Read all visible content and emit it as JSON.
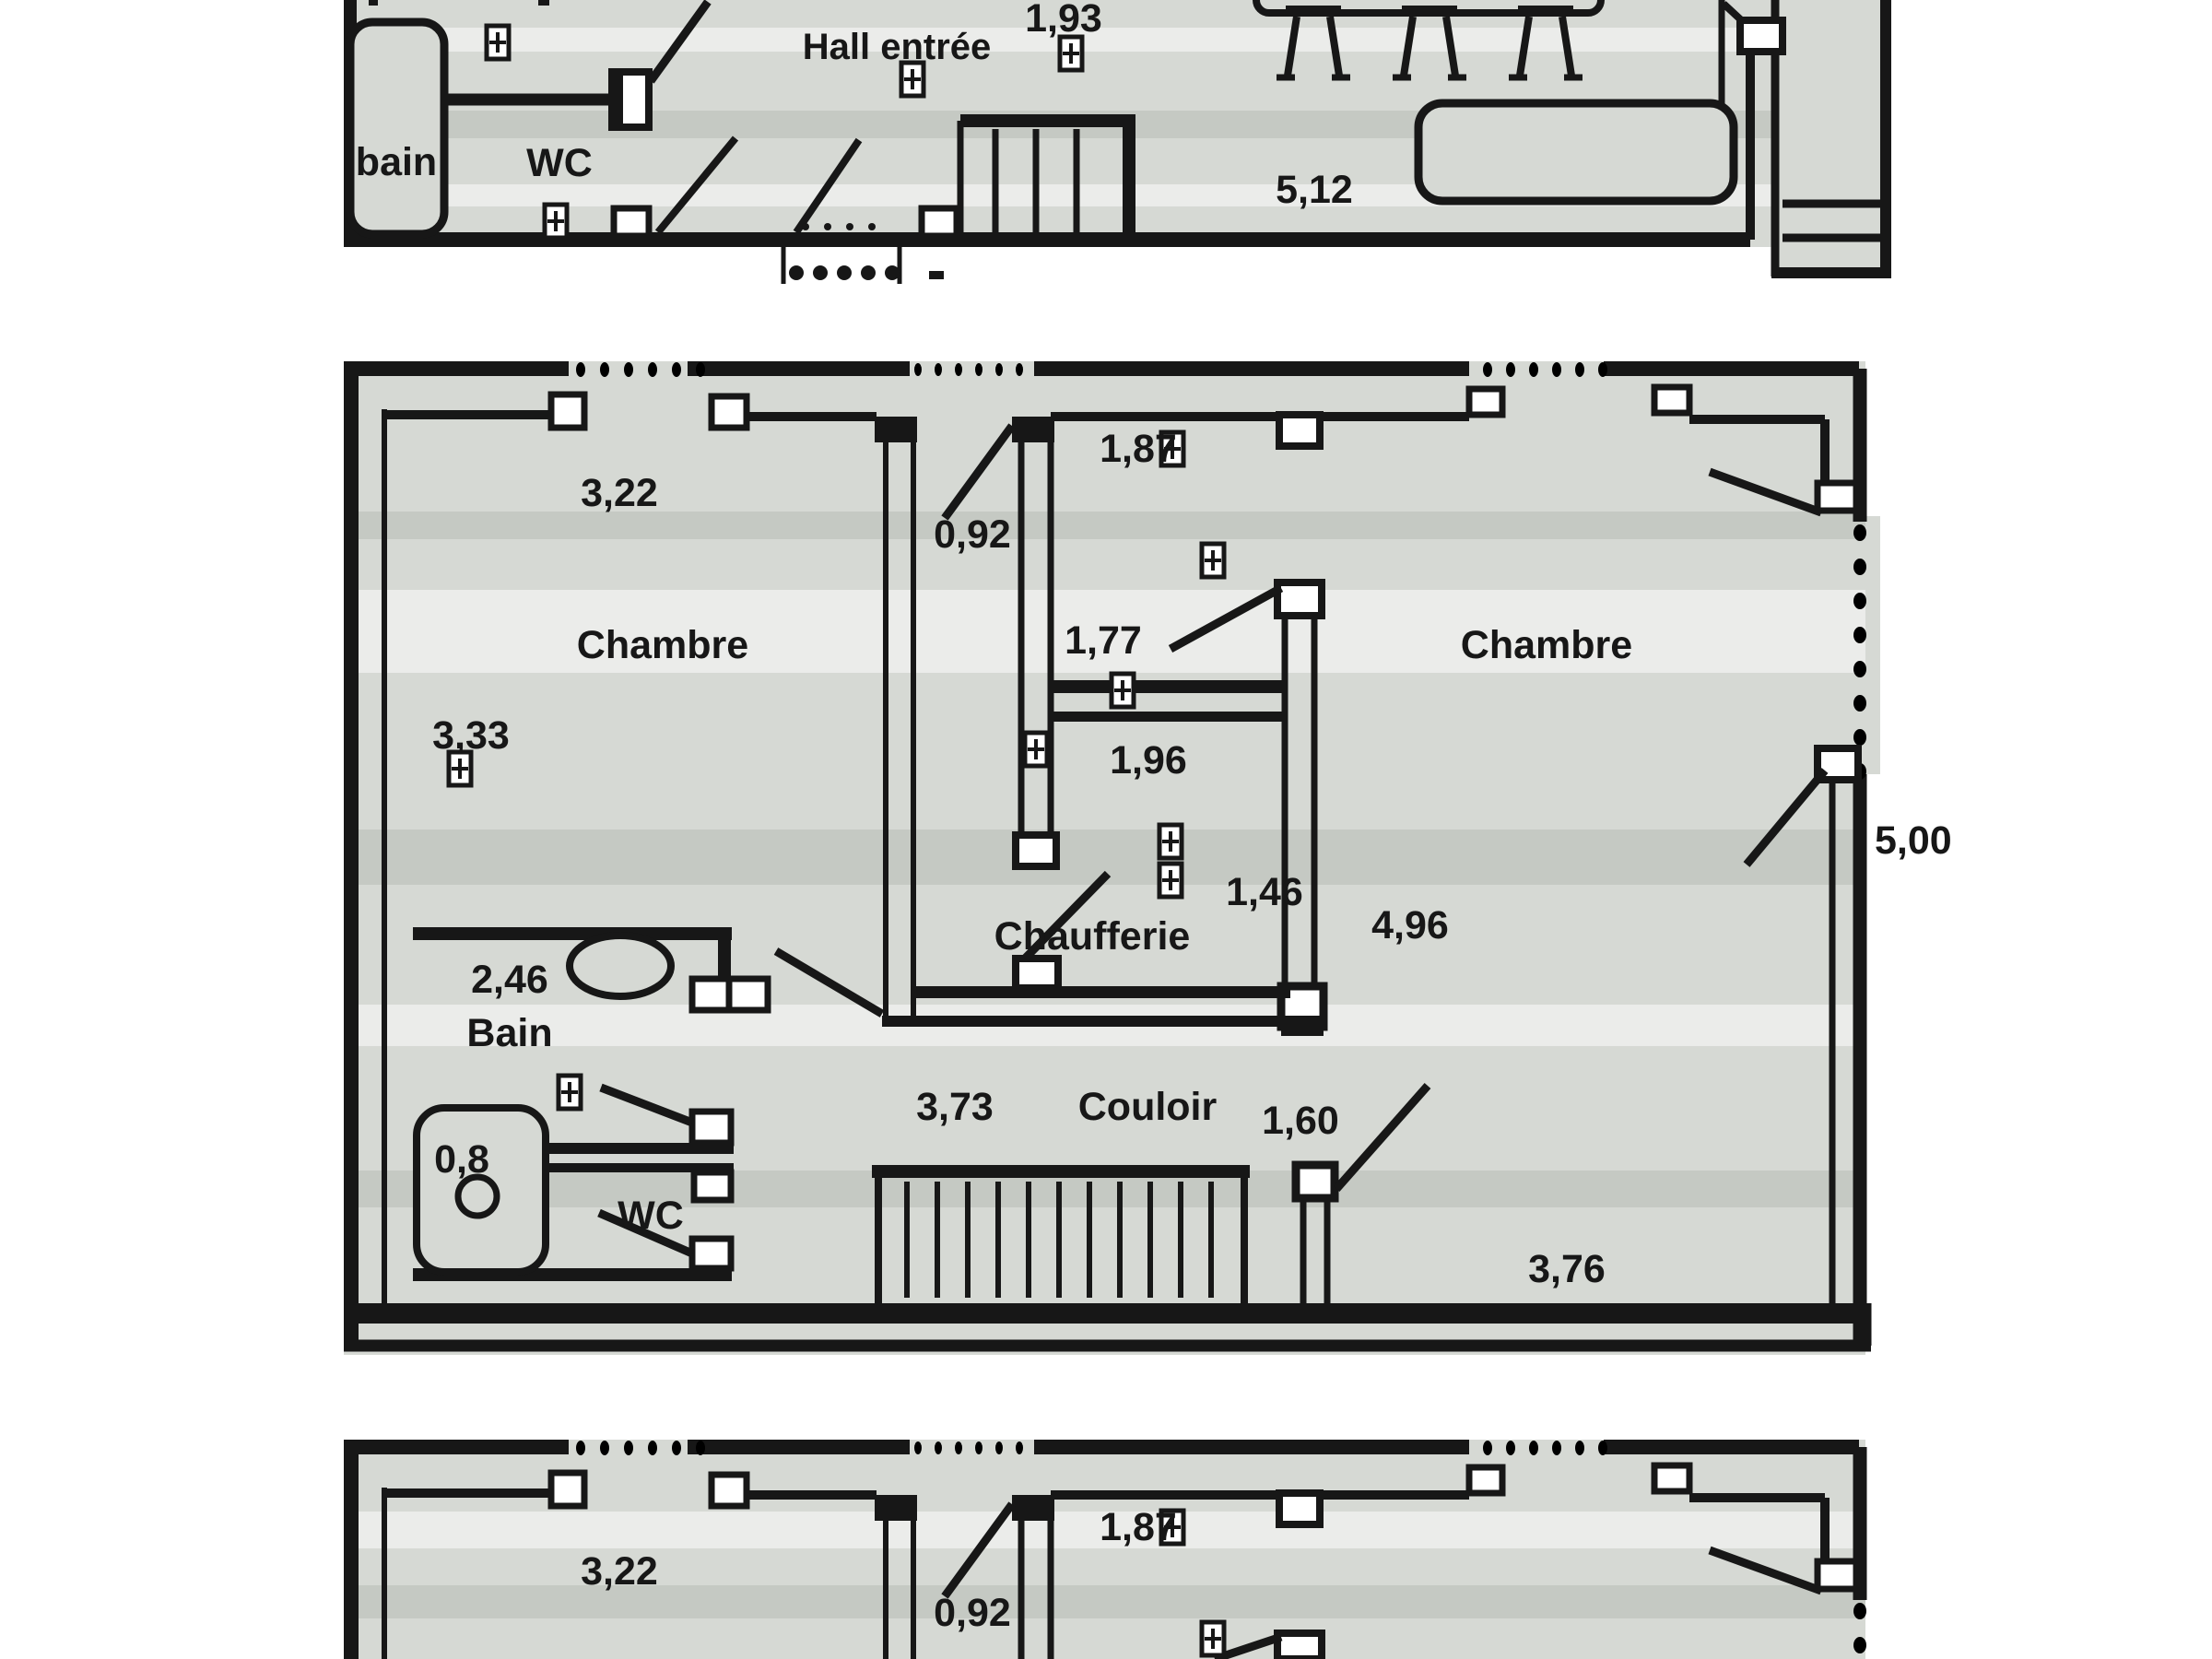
{
  "document_type": "scanned floor plan (French)",
  "plans": {
    "upper": {
      "rooms": {
        "bain": "bain",
        "wc": "WC",
        "hall": "Hall entrée"
      },
      "dims": {
        "d193": "1,93",
        "d512": "5,12"
      }
    },
    "main": {
      "rooms": {
        "chambre_left": "Chambre",
        "chambre_right": "Chambre",
        "chaufferie": "Chaufferie",
        "couloir": "Couloir",
        "bain": "Bain",
        "wc": "WC"
      },
      "dims": {
        "d322": "3,22",
        "d092": "0,92",
        "d187": "1,87",
        "d177": "1,77",
        "d333": "3,33",
        "d196": "1,96",
        "d146": "1,46",
        "d496": "4,96",
        "d246": "2,46",
        "d08": "0,8",
        "d373": "3,73",
        "d160": "1,60",
        "d376": "3,76",
        "d500": "5,00"
      }
    },
    "lower": {
      "dims": {
        "d322": "3,22",
        "d092": "0,92",
        "d187": "1,87"
      }
    }
  },
  "colors": {
    "ink": "#171717",
    "floor_grey": "#d6d9d4",
    "paper": "#ffffff"
  }
}
